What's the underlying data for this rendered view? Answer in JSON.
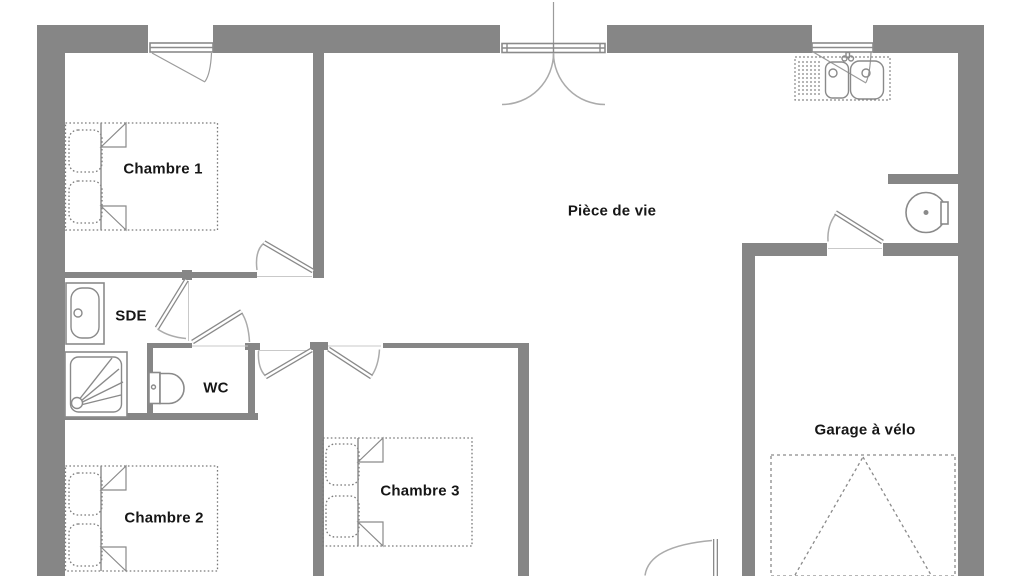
{
  "floor_plan": {
    "colors": {
      "background": "#ffffff",
      "wall": "#868686",
      "fixture_line": "#8a8a8a",
      "door_arc": "#ababab",
      "bed_line": "#7a7a7a",
      "text": "#161616"
    },
    "rooms": [
      {
        "name": "chambre-1",
        "label": "Chambre 1"
      },
      {
        "name": "piece-de-vie",
        "label": "Pièce de vie"
      },
      {
        "name": "sde",
        "label": "SDE"
      },
      {
        "name": "wc",
        "label": "WC"
      },
      {
        "name": "chambre-2",
        "label": "Chambre 2"
      },
      {
        "name": "chambre-3",
        "label": "Chambre 3"
      },
      {
        "name": "garage-a-velo",
        "label": "Garage à vélo"
      }
    ],
    "fixtures": [
      {
        "name": "double-bed-chambre-1"
      },
      {
        "name": "double-bed-chambre-2"
      },
      {
        "name": "double-bed-chambre-3"
      },
      {
        "name": "washbasin"
      },
      {
        "name": "shower"
      },
      {
        "name": "toilet"
      },
      {
        "name": "kitchen-double-sink"
      },
      {
        "name": "water-heater"
      },
      {
        "name": "bike-parking-zone"
      },
      {
        "name": "window"
      },
      {
        "name": "entry-double-door"
      }
    ]
  }
}
